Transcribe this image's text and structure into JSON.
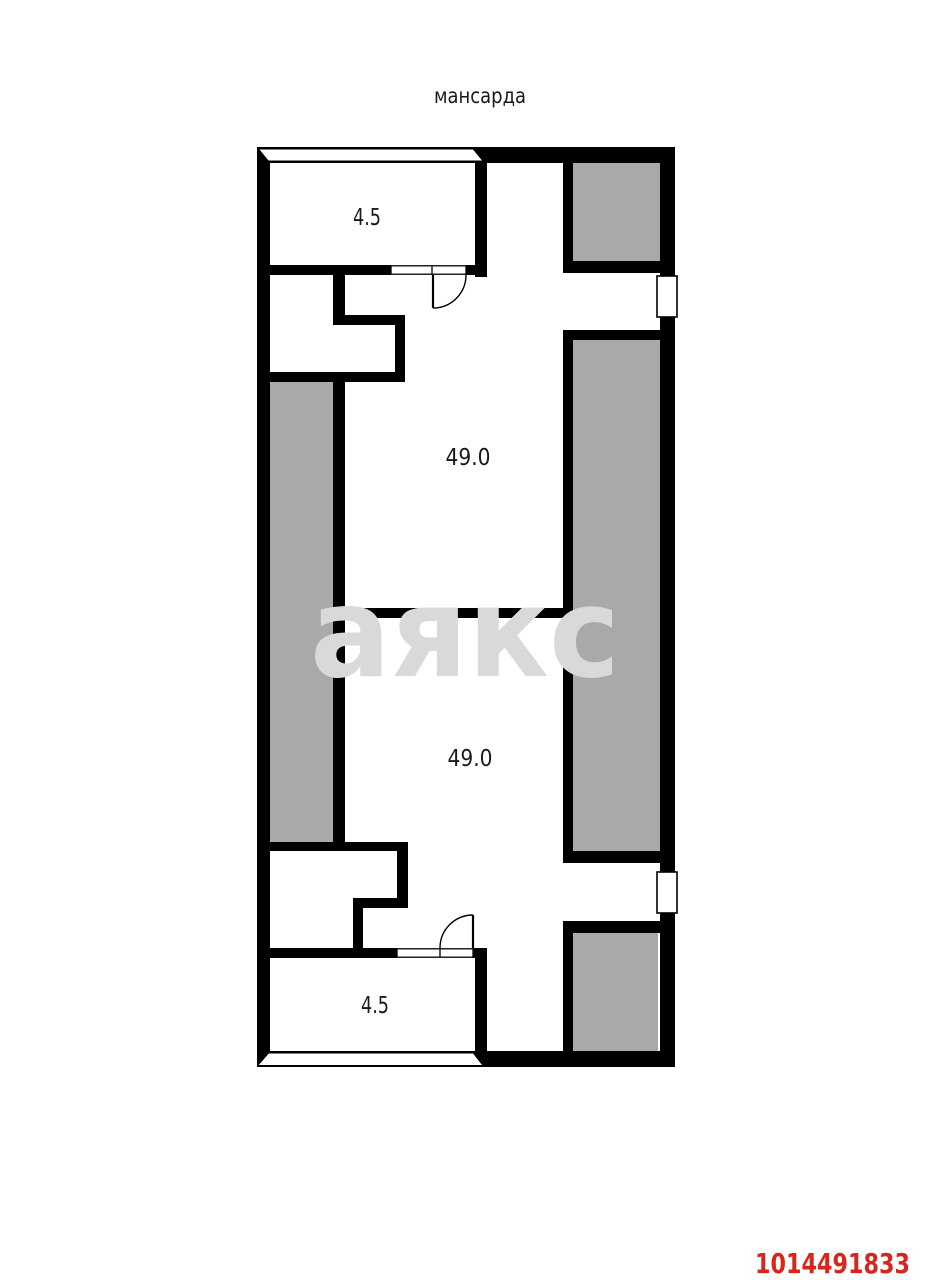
{
  "plan": {
    "title": "мансарда",
    "room_areas": {
      "top_small": "4.5",
      "upper_main": "49.0",
      "lower_main": "49.0",
      "bottom_small": "4.5"
    }
  },
  "watermark_text": "аякс",
  "listing_id": "1014491833",
  "colors": {
    "walls": "#000000",
    "shaded_zone": "#a9a9a9",
    "watermark": "#d9d9d9",
    "listing_id_red": "#d7261c",
    "label_text": "#1a1a1a",
    "background": "#ffffff"
  }
}
